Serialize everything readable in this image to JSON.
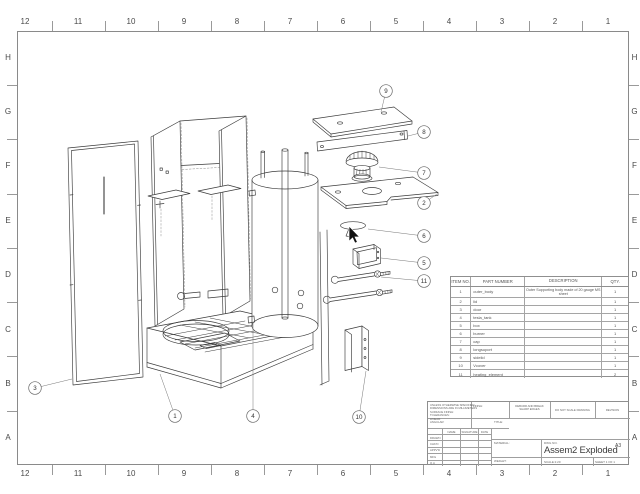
{
  "border": {
    "columns": [
      "12",
      "11",
      "10",
      "9",
      "8",
      "7",
      "6",
      "5",
      "4",
      "3",
      "2",
      "1"
    ],
    "rows": [
      "H",
      "G",
      "F",
      "E",
      "D",
      "C",
      "B",
      "A"
    ]
  },
  "bom": {
    "headers": [
      "ITEM NO.",
      "PART NUMBER",
      "DESCRIPTION",
      "QTY."
    ],
    "rows": [
      {
        "item": "1",
        "part": "outer_body",
        "desc": "Outer Supporting body made of 20 gauge MS sheet",
        "qty": "1"
      },
      {
        "item": "2",
        "part": "lid",
        "desc": "",
        "qty": "1"
      },
      {
        "item": "3",
        "part": "door",
        "desc": "",
        "qty": "1"
      },
      {
        "item": "4",
        "part": "tesla_tank",
        "desc": "",
        "qty": "1"
      },
      {
        "item": "5",
        "part": "box",
        "desc": "",
        "qty": "1"
      },
      {
        "item": "6",
        "part": "burner",
        "desc": "",
        "qty": "1"
      },
      {
        "item": "7",
        "part": "cap",
        "desc": "",
        "qty": "1"
      },
      {
        "item": "8",
        "part": "longsuport",
        "desc": "",
        "qty": "1"
      },
      {
        "item": "9",
        "part": "sidelid",
        "desc": "",
        "qty": "1"
      },
      {
        "item": "10",
        "part": "Vcover",
        "desc": "",
        "qty": "1"
      },
      {
        "item": "11",
        "part": "heating_element",
        "desc": "",
        "qty": "2"
      }
    ]
  },
  "balloons": [
    "9",
    "8",
    "7",
    "2",
    "6",
    "5",
    "11",
    "10",
    "3",
    "1",
    "4"
  ],
  "title_block": {
    "tolerance_lines": [
      "UNLESS OTHERWISE SPECIFIED:",
      "DIMENSIONS ARE IN MILLIMETERS",
      "SURFACE FINISH:",
      "TOLERANCES:",
      "   LINEAR:",
      "   ANGULAR:"
    ],
    "finish_label": "FINISH:",
    "deburr": "DEBURR AND BREAK SHARP EDGES",
    "do_not_scale": "DO NOT SCALE DRAWING",
    "revision": "REVISION",
    "sig_headers": [
      "NAME",
      "SIGNATURE",
      "DATE"
    ],
    "sig_rows": [
      "DRAWN",
      "CHK'D",
      "APPV'D",
      "MFG",
      "Q.A"
    ],
    "title_label": "TITLE:",
    "material_label": "MATERIAL:",
    "weight_label": "WEIGHT:",
    "dwg_label": "DWG NO.",
    "dwg_title": "Assem2 Exploded",
    "sheet_size": "A3",
    "scale": "SCALE:1:20",
    "sheet": "SHEET 1 OF 1"
  }
}
